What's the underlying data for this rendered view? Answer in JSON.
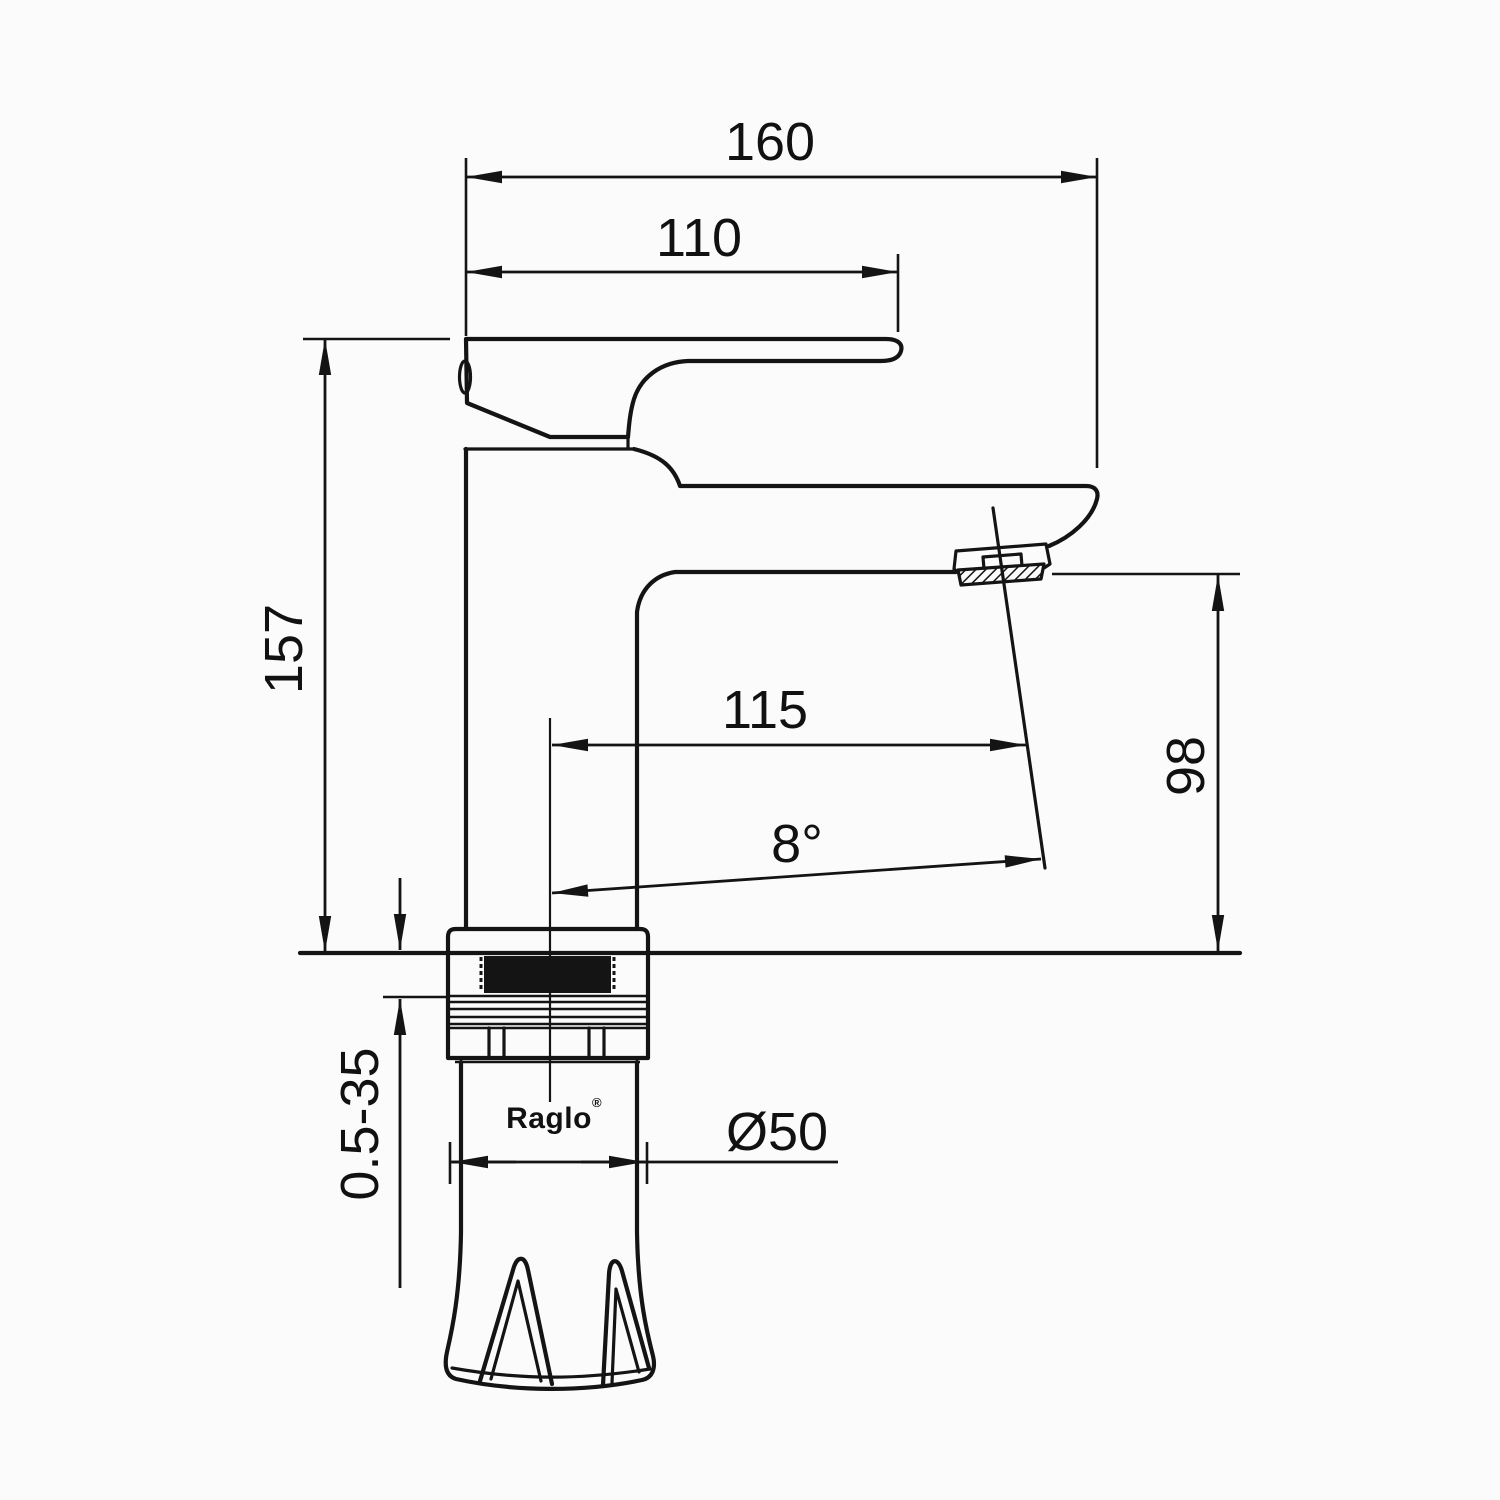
{
  "canvas": {
    "background": "#fbfbfb",
    "line_color": "#141414"
  },
  "brand": {
    "logo_text": "Raglo",
    "registered_mark": "®"
  },
  "dimensions": {
    "overall_depth_mm": {
      "label": "160",
      "orientation": "horizontal",
      "meaning": "overall depth to handle front"
    },
    "handle_length_mm": {
      "label": "110",
      "orientation": "horizontal",
      "meaning": "lever handle length"
    },
    "total_height_mm": {
      "label": "157",
      "orientation": "vertical",
      "meaning": "total body height above deck"
    },
    "spout_reach_mm": {
      "label": "115",
      "orientation": "horizontal",
      "meaning": "spout reach from centerline"
    },
    "spout_height_mm": {
      "label": "98",
      "orientation": "vertical",
      "meaning": "outlet height above deck"
    },
    "spout_angle": {
      "label": "8°",
      "orientation": "angular",
      "meaning": "outlet stream angle"
    },
    "mount_thickness_mm": {
      "label": "0.5-35",
      "orientation": "vertical",
      "meaning": "deck mounting thickness range"
    },
    "base_diameter_mm": {
      "label": "Ø50",
      "orientation": "diameter",
      "meaning": "base diameter"
    }
  }
}
